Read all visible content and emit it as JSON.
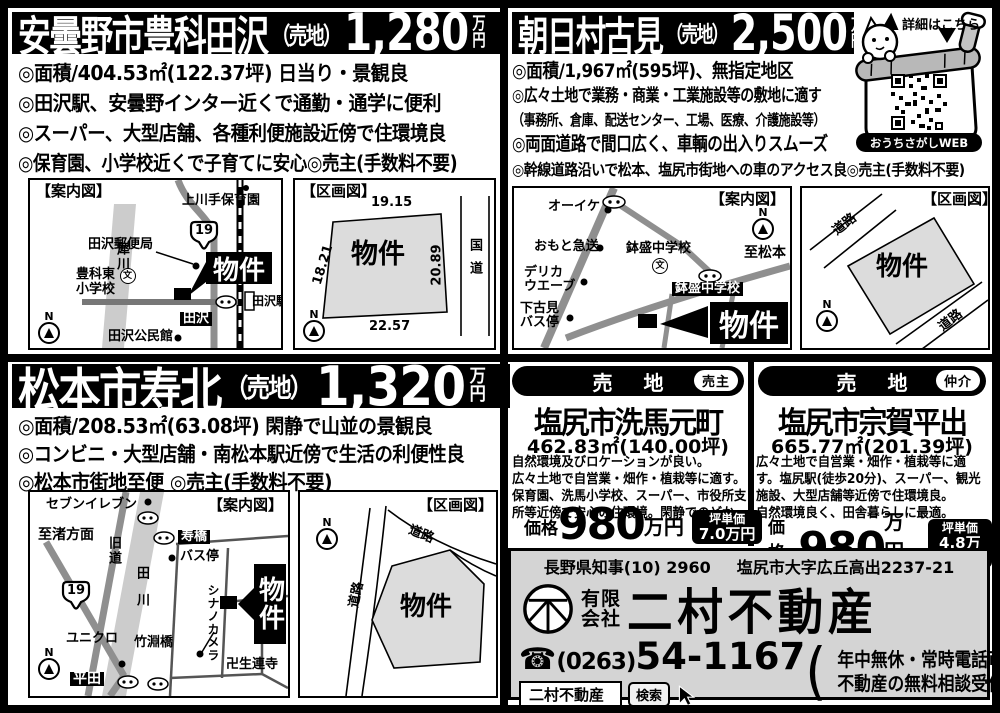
{
  "units": {
    "top": "万",
    "bottom": "円"
  },
  "icons": {
    "north": "N",
    "school_mark": "文"
  },
  "listings": {
    "tazawa": {
      "title": "安曇野市豊科田沢",
      "sale_type": "（売地）",
      "price": "1,280",
      "bullets": [
        "◎面積/404.53㎡(122.37坪) 日当り・景観良",
        "◎田沢駅、安曇野インター近くで通勤・通学に便利",
        "◎スーパー、大型店舗、各種利便施設近傍で住環境良",
        "◎保育園、小学校近くで子育てに安心◎売主(手数料不要)"
      ],
      "guide": {
        "caption": "【案内図】",
        "nursery": "上川手保育園",
        "route": "19",
        "post_office": "田沢郵便局",
        "river": "犀川",
        "school_l1": "豊科東",
        "school_l2": "小学校",
        "property": "物件",
        "station": "田沢駅",
        "crossing": "田沢",
        "hall": "田沢公民館"
      },
      "plot": {
        "caption": "【区画図】",
        "dim_top": "19.15",
        "dim_left": "18.21",
        "dim_right": "20.89",
        "dim_bottom": "22.57",
        "parcel": "物件",
        "road": "国道"
      }
    },
    "asahi": {
      "title": "朝日村古見",
      "sale_type": "（売地）",
      "price": "2,500",
      "bullets": [
        "◎面積/1,967㎡(595坪)、無指定地区",
        "◎広々土地で業務・商業・工業施設等の敷地に適す",
        "（事務所、倉庫、配送センター、工場、医療、介護施設等）",
        "◎両面道路で間口広く、車輌の出入りスムーズ",
        "◎幹線道路沿いで松本、塩尻市街地への車のアクセス良◎売主(手数料不要)"
      ],
      "guide": {
        "caption": "【案内図】",
        "shop1": "オーイケ",
        "shop2": "おもと急送",
        "school": "鉢盛中学校",
        "shop3_l1": "デリカ",
        "shop3_l2": "ウエーブ",
        "to_matsumoto": "至松本",
        "school_label": "鉢盛中学校",
        "bus_l1": "下古見",
        "bus_l2": "バス停",
        "property": "物件"
      },
      "plot": {
        "caption": "【区画図】",
        "road_top": "道路",
        "road_bottom": "道路",
        "parcel": "物件"
      }
    },
    "kotobuki": {
      "title": "松本市寿北",
      "sale_type": "（売地）",
      "price": "1,320",
      "bullets": [
        "◎面積/208.53㎡(63.08坪) 閑静で山並の景観良",
        "◎コンビニ・大型店舗・南松本駅近傍で生活の利便性良",
        "◎松本市街地至便 ◎売主(手数料不要)"
      ],
      "guide": {
        "caption": "【案内図】",
        "seven": "セブンイレブン",
        "bridge1": "寿橋",
        "bus": "バス停",
        "to_nagisa": "至渚方面",
        "old_road": "旧道",
        "river": "田川",
        "route": "19",
        "uniqlo": "ユニクロ",
        "bridge2": "竹淵橋",
        "camera": "シナノカメラ",
        "temple": "卍生連寺",
        "crossing": "平田",
        "property": "物件"
      },
      "plot": {
        "caption": "【区画図】",
        "road1": "道路",
        "road2": "道路",
        "parcel": "物件"
      }
    },
    "seba": {
      "banner": "売 地",
      "badge": "売主",
      "title": "塩尻市洗馬元町",
      "area": "462.83㎡(140.00坪)",
      "desc": [
        "自然環境及びロケーションが良い。",
        "広々土地で自営業・畑作・植栽等に適す。",
        "保育園、洗馬小学校、スーパー、市役所支",
        "所等近傍で安心の住環境。閑静でのどか。"
      ],
      "price_label": "価格",
      "price": "980",
      "price_unit": "万円",
      "tsubo_label": "坪単価",
      "tsubo_value": "7.0万円"
    },
    "soga": {
      "banner": "売 地",
      "badge": "仲介",
      "title": "塩尻市宗賀平出",
      "area": "665.77㎡(201.39坪)",
      "desc": [
        "広々土地で自営業・畑作・植栽等に適",
        "す。塩尻駅(徒歩20分)、スーパー、観光",
        "施設、大型店舗等近傍で住環境良。",
        "自然環境良く、田舎暮らしに最適。"
      ],
      "price_label": "価格",
      "price": "980",
      "price_unit": "万円",
      "tsubo_label": "坪単価",
      "tsubo_value": "4.8万円"
    }
  },
  "mascot": {
    "details": "詳細はこちら",
    "web": "おうちさがしWEB"
  },
  "company": {
    "license": "長野県知事(10) 2960",
    "address": "塩尻市大字広丘高出2237-21",
    "corp1": "有限",
    "corp2": "会社",
    "name": "二村不動産",
    "phone_icon": "☎",
    "tel_area": "(0263)",
    "tel_number": "54-1167",
    "note1": "年中無休・常時電話可",
    "note2": "不動産の無料相談受付",
    "paren_open": "(",
    "paren_close": ")",
    "search_text": "二村不動産",
    "search_button": "検索"
  },
  "colors": {
    "ink": "#000000",
    "road_gray": "#8f8f8f",
    "river_gray": "#cccccc",
    "parcel_fill": "#dcdcdc",
    "company_bg": "#d4d4d4"
  }
}
